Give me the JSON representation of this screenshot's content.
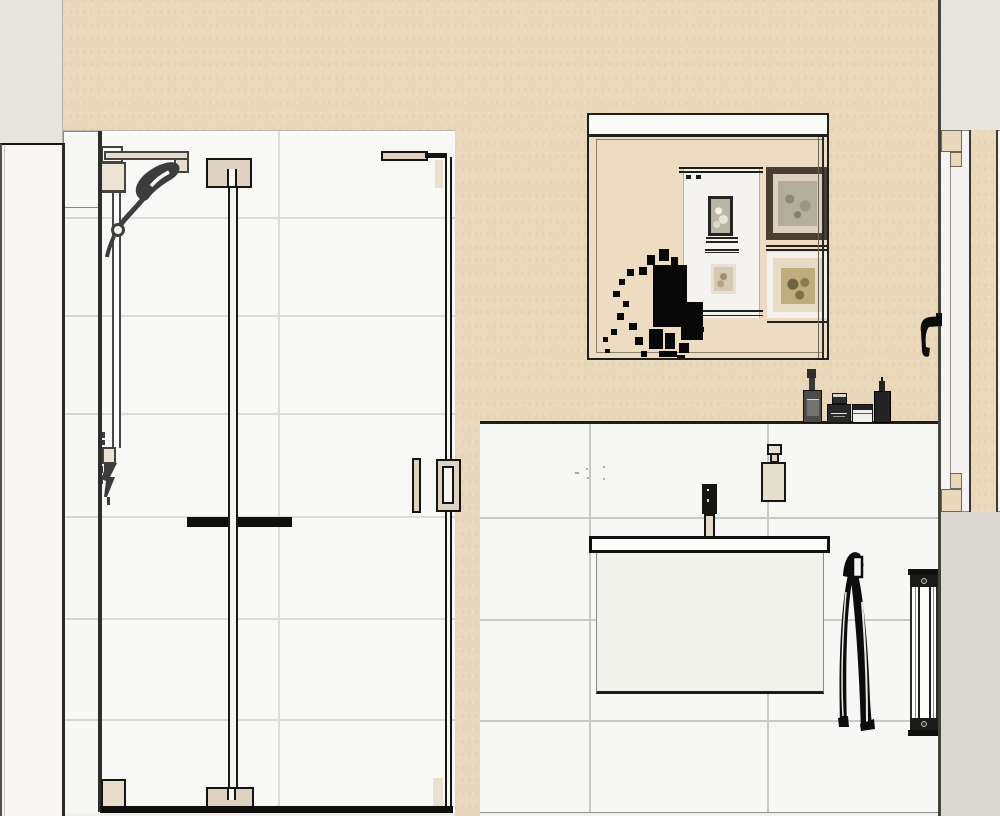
{
  "scene": {
    "type": "bathroom-interior-elevation-render",
    "walls": {
      "upper_wall_color": "#e9d8ba",
      "tile_color": "#f7f7f5",
      "grout_color": "#c9c9c7",
      "exterior_gray": "#e7e5e0",
      "lower_right_gray": "#dcd9d3"
    },
    "objects": [
      {
        "name": "left-door-panel"
      },
      {
        "name": "shower-enclosure-glass"
      },
      {
        "name": "shower-slide-rail"
      },
      {
        "name": "hand-shower-with-hose"
      },
      {
        "name": "shower-door-towel-bar"
      },
      {
        "name": "shower-door-handles"
      },
      {
        "name": "mirror"
      },
      {
        "name": "mirror-reflection-framed-pictures",
        "count": 4
      },
      {
        "name": "mirror-reflection-plant-silhouette"
      },
      {
        "name": "toiletry-items-on-ledge",
        "count": 4
      },
      {
        "name": "half-wall-ledge"
      },
      {
        "name": "washbasin-with-faucet"
      },
      {
        "name": "vanity-cabinet"
      },
      {
        "name": "soap-dispenser"
      },
      {
        "name": "hand-towel"
      },
      {
        "name": "vertical-radiator"
      },
      {
        "name": "right-door-with-frame"
      },
      {
        "name": "right-door-handle"
      }
    ],
    "palette": {
      "outline_black": "#141413",
      "fixture_black": "#0c0c0c",
      "hardware_beige": "#e0d6c2",
      "cabinet_white": "#f1f1ec",
      "mirror_reflection_beige": "#eddcc2",
      "picture_frame_dark_brown": "#493f31",
      "basin_white": "#fcfcfa"
    },
    "visible_text": ""
  }
}
